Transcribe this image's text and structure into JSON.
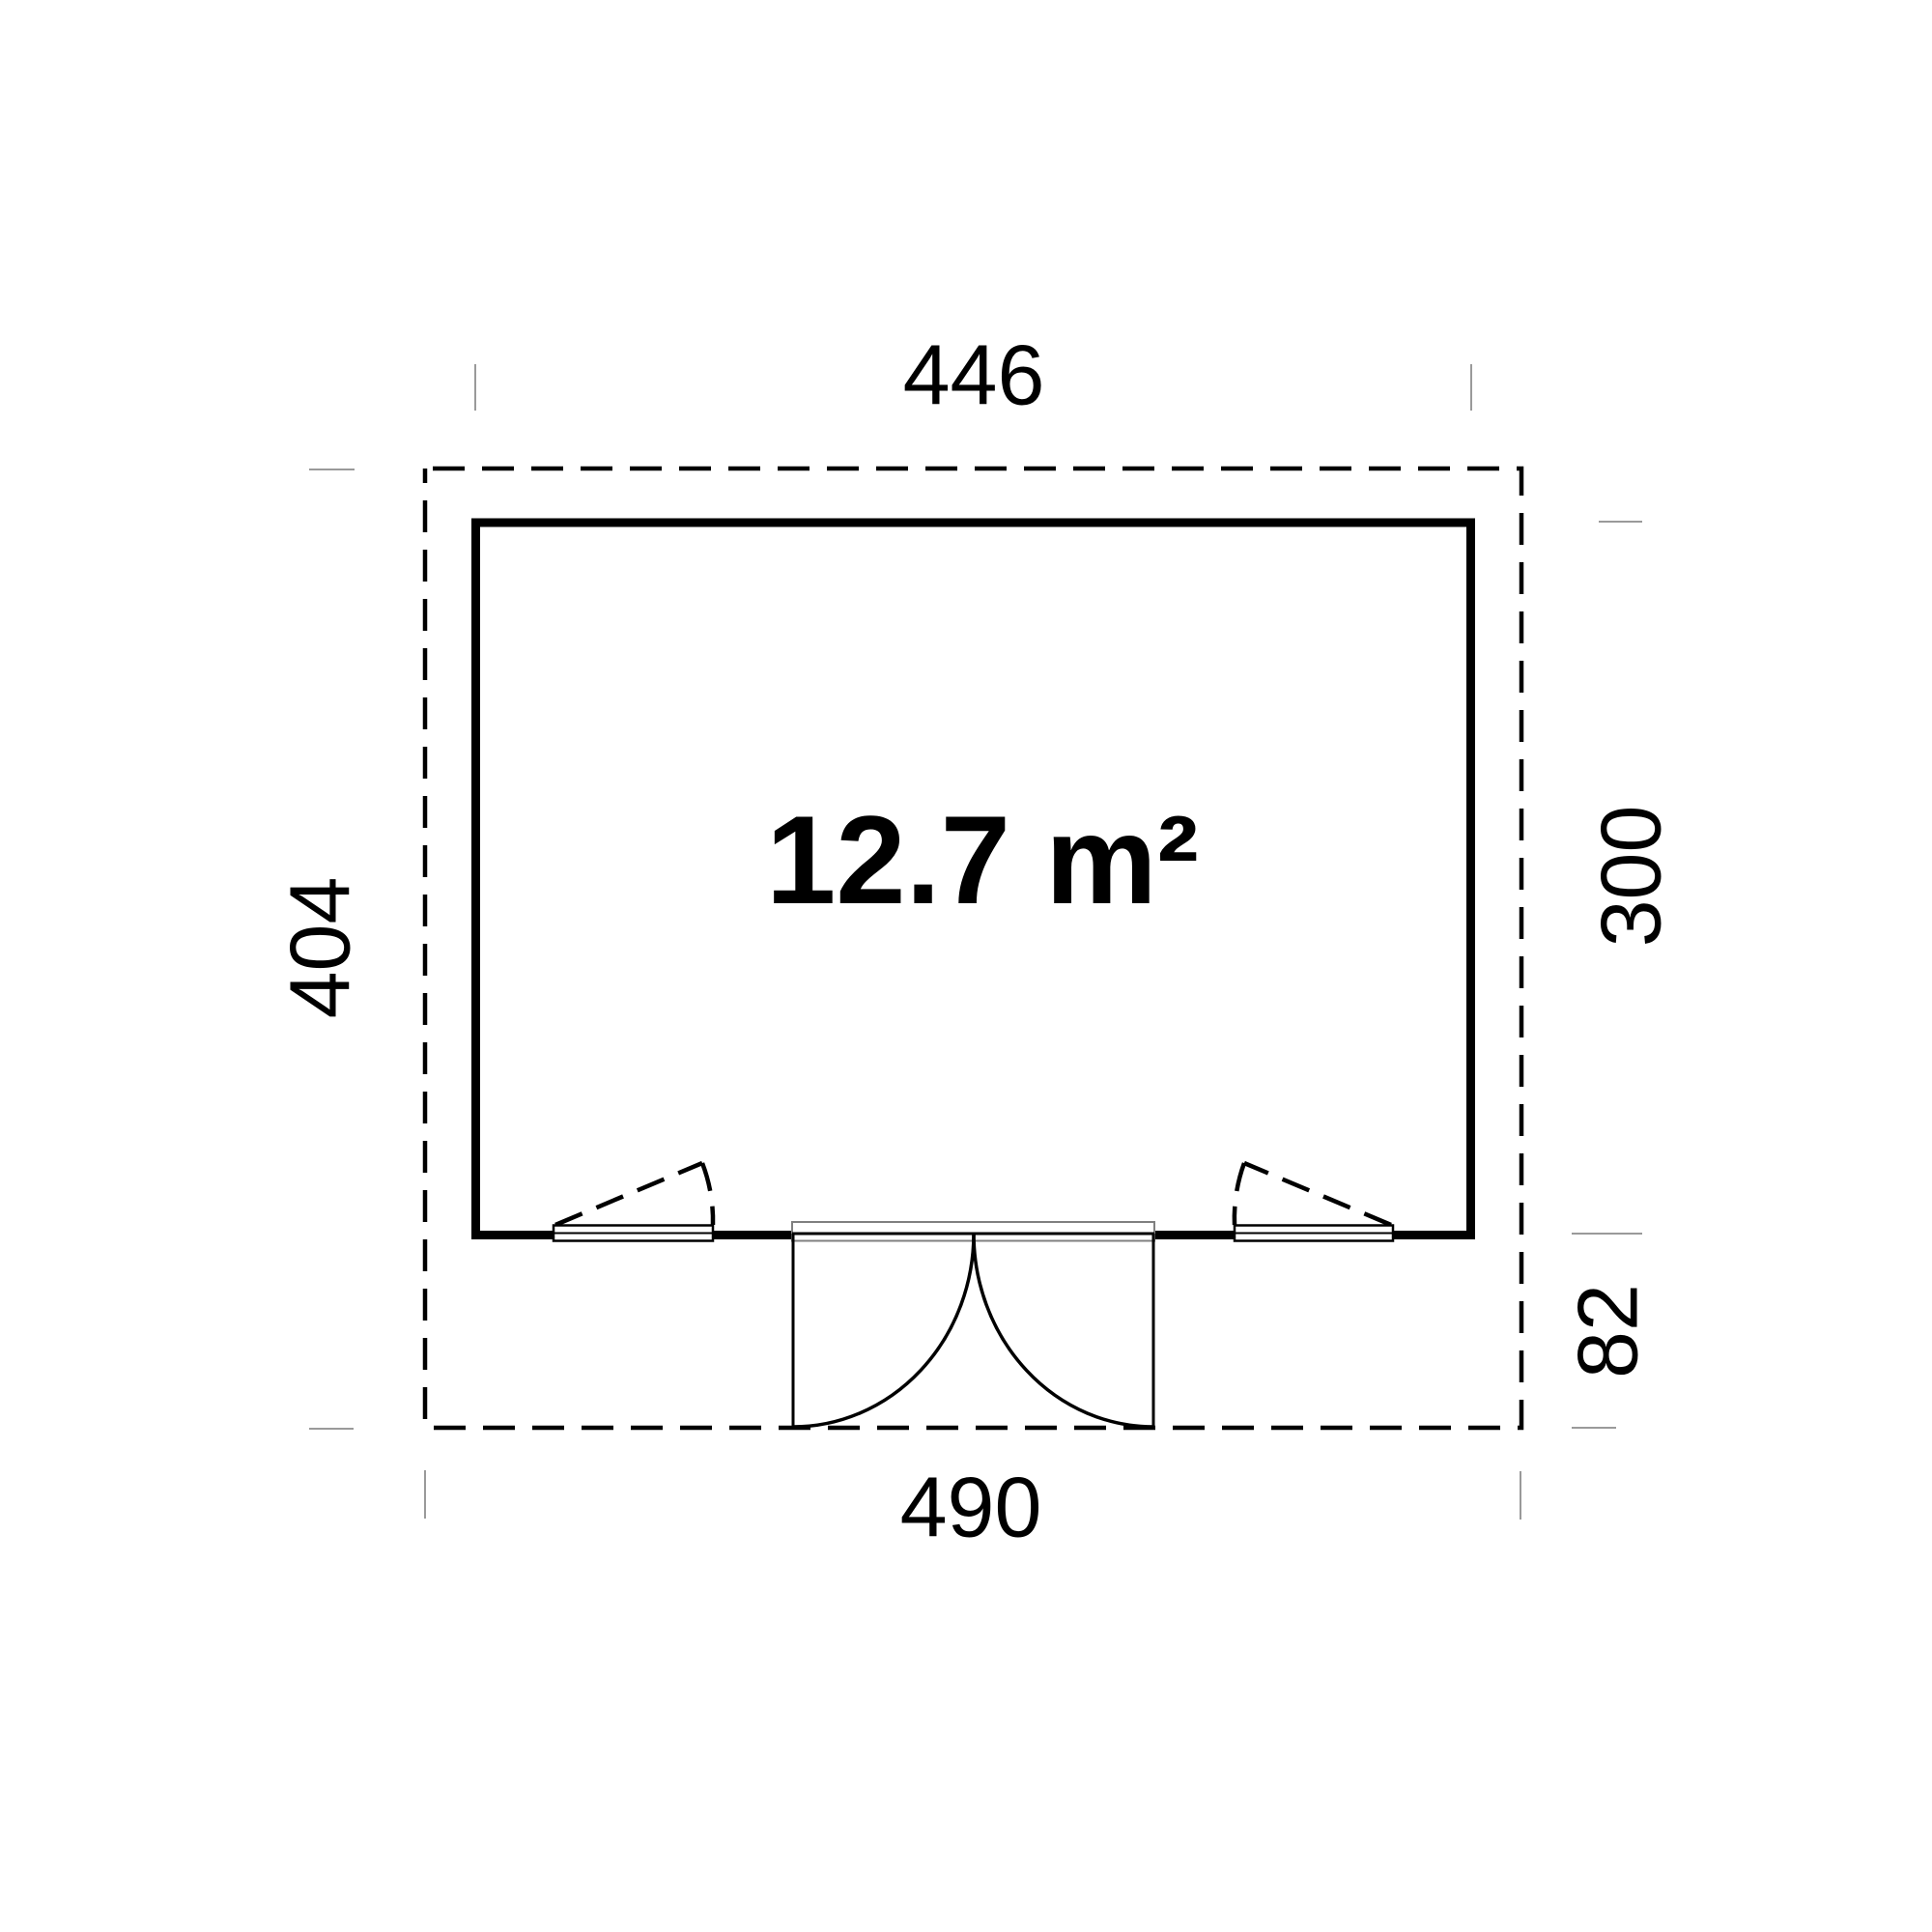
{
  "floorplan": {
    "type": "garden-house plan view",
    "area_label": "12.7 m²",
    "dimensions": {
      "building_width_top": "446",
      "overall_depth_left": "404",
      "building_depth_right": "300",
      "door_swing_depth_right": "82",
      "overall_width_bottom": "490"
    },
    "features": {
      "door": "double outward-swinging door, centered on bottom wall",
      "windows": "two awning windows flanking the door, bottom wall"
    },
    "colors": {
      "line": "#000000",
      "tick": "#9a9a9a",
      "frame_gray": "#808080",
      "background": "#ffffff"
    }
  }
}
